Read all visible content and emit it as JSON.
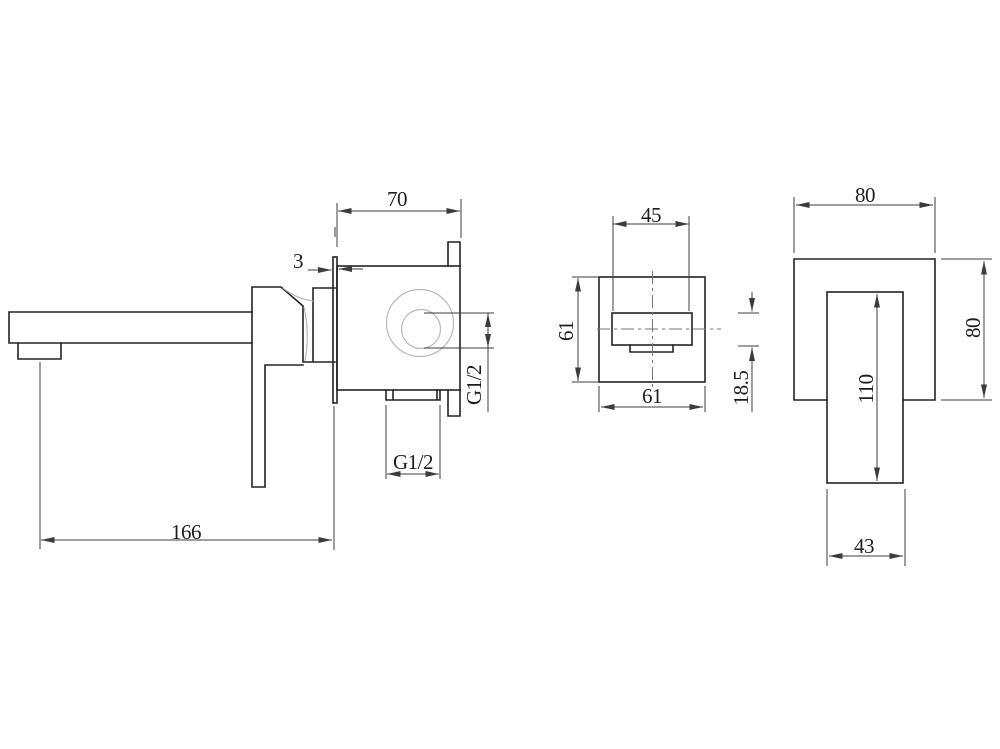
{
  "drawing": {
    "background": "#ffffff",
    "line_color": "#232323",
    "thin_line_color": "#b9b9b9",
    "views": {
      "side_view": {
        "description": "wall-mounted-mixer-side-view",
        "dims": {
          "spout_reach": "166",
          "body_depth": "70",
          "plate_thickness": "3",
          "side_inlet_thread": "G1/2",
          "bottom_inlet_thread": "G1/2"
        }
      },
      "front_view": {
        "description": "concealed-body-front-view",
        "dims": {
          "handle_base_width": "45",
          "plate_height": "61",
          "plate_width": "61",
          "handle_base_height": "18.5"
        }
      },
      "handle_view": {
        "description": "wall-plate-and-lever-front-view",
        "dims": {
          "plate_width": "80",
          "plate_height": "80",
          "lever_length": "110",
          "lever_width": "43"
        }
      }
    }
  }
}
